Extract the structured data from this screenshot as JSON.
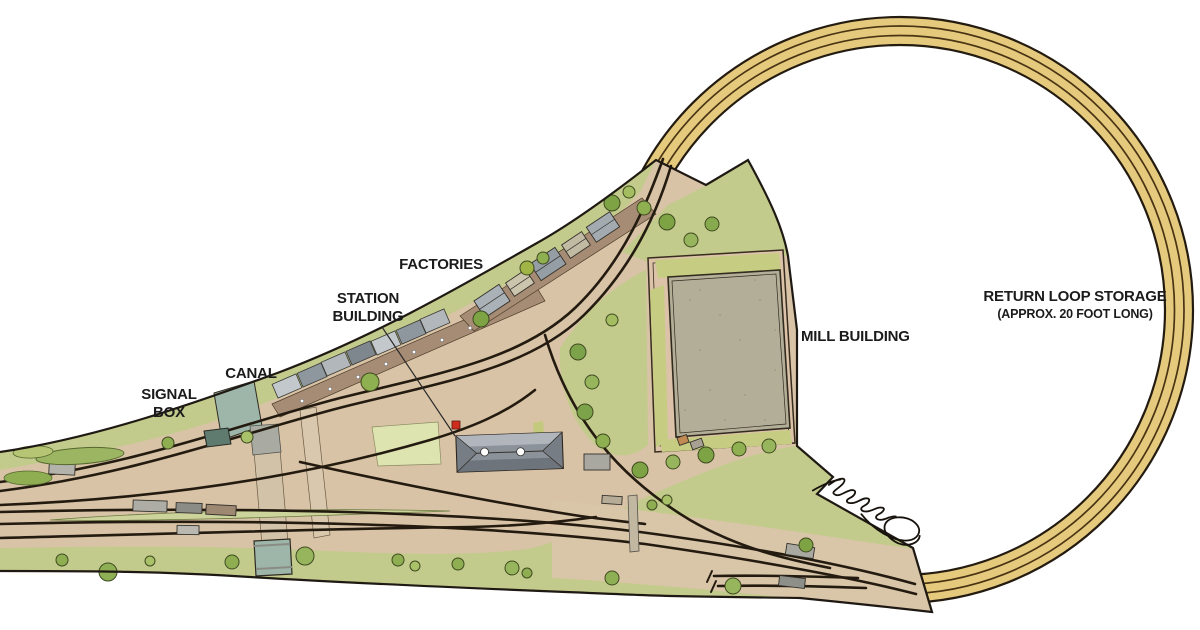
{
  "diagram": {
    "type": "model-railway-track-plan",
    "labels": {
      "factories": "FACTORIES",
      "station_building_1": "STATION",
      "station_building_2": "BUILDING",
      "canal": "CANAL",
      "signal_box_1": "SIGNAL",
      "signal_box_2": "BOX",
      "mill_building": "MILL BUILDING",
      "return_loop_1": "RETURN LOOP STORAGE",
      "return_loop_2": "(APPROX. 20 FOOT LONG)"
    },
    "signature": "handwritten artist signature",
    "colors": {
      "background": "#ffffff",
      "loop_bed": "#e5ca7e",
      "track_line": "#241b10",
      "track_inner_line": "#4a3413",
      "scenic_base": "#d8c3a6",
      "corridor": "#d9c5a8",
      "grass": "#c3cb8c",
      "canal_water": "#9db6a9",
      "mill_fill": "#b3ae98",
      "courtyard": "#dbc2a8",
      "walkway_brown": "#a68c74",
      "platform_light": "#c3c8cc",
      "platform_dark": "#8e969e",
      "station_roof": "#8c929a",
      "lawn": "#dde4b0",
      "signal_red": "#cf2c1e",
      "label_color": "#1b1b1b"
    }
  }
}
